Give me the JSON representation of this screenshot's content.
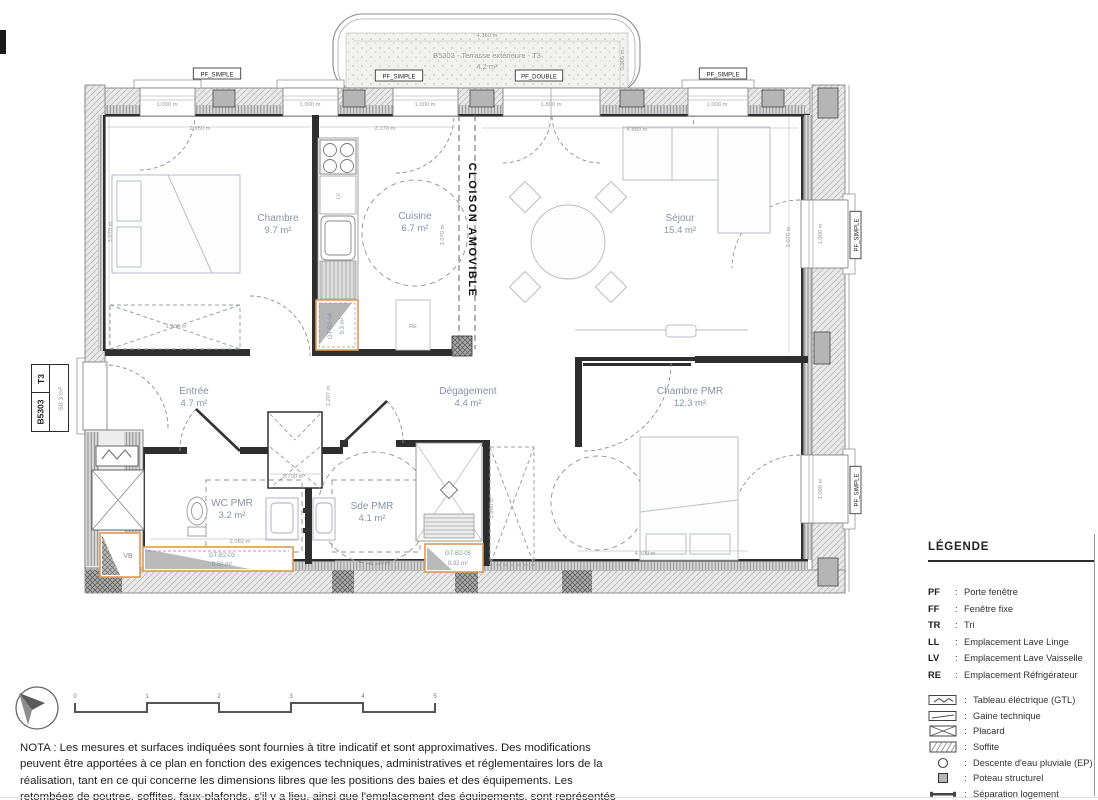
{
  "title_block": {
    "unit": "B5303",
    "type": "T3",
    "area": "60.3 m²"
  },
  "terrace": {
    "label": "B5303 - Terrasse extérieure - T3",
    "area": "4.2 m²",
    "dim_top": "4.360 m",
    "dim_right": "0.905 m"
  },
  "window_tags": [
    {
      "label": "PF_SIMPLE",
      "x": 217,
      "y": 75,
      "rot": 0
    },
    {
      "label": "PF_SIMPLE",
      "x": 399,
      "y": 77,
      "rot": 0
    },
    {
      "label": "PF_DOUBLE",
      "x": 539,
      "y": 77,
      "rot": 0
    },
    {
      "label": "PF_SIMPLE",
      "x": 723,
      "y": 75,
      "rot": 0
    },
    {
      "label": "PF_SIMPLE",
      "x": 857,
      "y": 235,
      "rot": -90
    },
    {
      "label": "PF_SIMPLE",
      "x": 857,
      "y": 490,
      "rot": -90
    }
  ],
  "rooms": [
    {
      "name": "Chambre",
      "area": "9.7 m²",
      "x": 278,
      "y": 221
    },
    {
      "name": "Cuisine",
      "area": "6.7 m²",
      "x": 415,
      "y": 219
    },
    {
      "name": "Séjour",
      "area": "15.4 m²",
      "x": 680,
      "y": 221
    },
    {
      "name": "Entrée",
      "area": "4.7 m²",
      "x": 194,
      "y": 394
    },
    {
      "name": "Dégagement",
      "area": "4.4 m²",
      "x": 468,
      "y": 394
    },
    {
      "name": "Chambre PMR",
      "area": "12.3 m²",
      "x": 690,
      "y": 394
    },
    {
      "name": "WC PMR",
      "area": "3.2 m²",
      "x": 232,
      "y": 506
    },
    {
      "name": "Sde PMR",
      "area": "4.1 m²",
      "x": 372,
      "y": 509
    }
  ],
  "annotations": {
    "cloison": "CLOISON AMOVIBLE",
    "vb": "VB",
    "lv": "LV",
    "re": "RE",
    "gt04": {
      "code": "GT-B2-04",
      "area": "0.3 m²"
    },
    "gt03": {
      "code": "GT-B2-03",
      "area": "0.50 m²"
    },
    "gt05": {
      "code": "GT-B2-05",
      "area": "0.32 m²"
    }
  },
  "dimensions": [
    {
      "t": "1.000 m",
      "x": 167,
      "y": 106,
      "r": 0
    },
    {
      "t": "1.000 m",
      "x": 310,
      "y": 106,
      "r": 0
    },
    {
      "t": "1.000 m",
      "x": 425,
      "y": 106,
      "r": 0
    },
    {
      "t": "1.800 m",
      "x": 551,
      "y": 106,
      "r": 0
    },
    {
      "t": "1.000 m",
      "x": 717,
      "y": 106,
      "r": 0
    },
    {
      "t": "2.950 m",
      "x": 200,
      "y": 130,
      "r": 0
    },
    {
      "t": "2.170 m",
      "x": 385,
      "y": 130,
      "r": 0
    },
    {
      "t": "4.880 m",
      "x": 637,
      "y": 131,
      "r": 0
    },
    {
      "t": "4.360 m",
      "x": 487,
      "y": 37,
      "r": 0
    },
    {
      "t": "0.905 m",
      "x": 624,
      "y": 60,
      "r": -90
    },
    {
      "t": "3.070 m",
      "x": 112,
      "y": 232,
      "r": -90
    },
    {
      "t": "3.070 m",
      "x": 444,
      "y": 235,
      "r": -90
    },
    {
      "t": "3.070 m",
      "x": 790,
      "y": 237,
      "r": -90
    },
    {
      "t": "1.900 m",
      "x": 176,
      "y": 328,
      "r": 0
    },
    {
      "t": "1.207 m",
      "x": 330,
      "y": 396,
      "r": -90
    },
    {
      "t": "0.700 m",
      "x": 293,
      "y": 478,
      "r": 0
    },
    {
      "t": "2.082 m",
      "x": 240,
      "y": 543,
      "r": 0
    },
    {
      "t": "1.740 m",
      "x": 380,
      "y": 565,
      "r": 0
    },
    {
      "t": "4.500 m",
      "x": 645,
      "y": 555,
      "r": 0
    },
    {
      "t": "1.800 m",
      "x": 493,
      "y": 508,
      "r": -90
    },
    {
      "t": "1.000 m",
      "x": 822,
      "y": 234,
      "r": -90
    },
    {
      "t": "1.000 m",
      "x": 822,
      "y": 489,
      "r": -90
    }
  ],
  "legend": {
    "title": "LÉGENDE",
    "abbrev": [
      {
        "key": "PF",
        "label": "Porte fenêtre"
      },
      {
        "key": "FF",
        "label": "Fenêtre fixe"
      },
      {
        "key": "TR",
        "label": "Tri"
      },
      {
        "key": "LL",
        "label": "Emplacement Lave Linge"
      },
      {
        "key": "LV",
        "label": "Emplacement Lave Vaisselle"
      },
      {
        "key": "RE",
        "label": "Emplacement Réfrigérateur"
      }
    ],
    "symbols": [
      {
        "icon": "gtl-icon",
        "label": "Tableau éléctrique (GTL)"
      },
      {
        "icon": "gaine-icon",
        "label": "Gaine technique"
      },
      {
        "icon": "placard-icon",
        "label": "Placard"
      },
      {
        "icon": "soffite-icon",
        "label": "Soffite"
      },
      {
        "icon": "ep-icon",
        "label": "Descente d'eau pluviale (EP)"
      },
      {
        "icon": "poteau-icon",
        "label": "Poteau structurel"
      },
      {
        "icon": "separation-icon",
        "label": "Séparation logement"
      }
    ]
  },
  "scale_bar": {
    "ticks": [
      "0",
      "1",
      "2",
      "3",
      "4",
      "5"
    ]
  },
  "nota": "NOTA : Les mesures et surfaces indiquées sont fournies à titre indicatif et sont approximatives. Des modifications peuvent être apportées à ce plan en fonction des exigences techniques, administratives et réglementaires lors de la réalisation, tant en ce qui concerne les dimensions libres que les positions des baies et des équipements. Les retombées de poutres, soffites, faux-plafonds, s'il y a lieu, ainsi que l'emplacement des équipements, sont représentés à titre indicatif.",
  "colors": {
    "accent_orange": "#db9a55",
    "room_text": "#8593a6",
    "wall_dark": "#2e2e2e",
    "hatch_line": "#b8b8b8"
  }
}
